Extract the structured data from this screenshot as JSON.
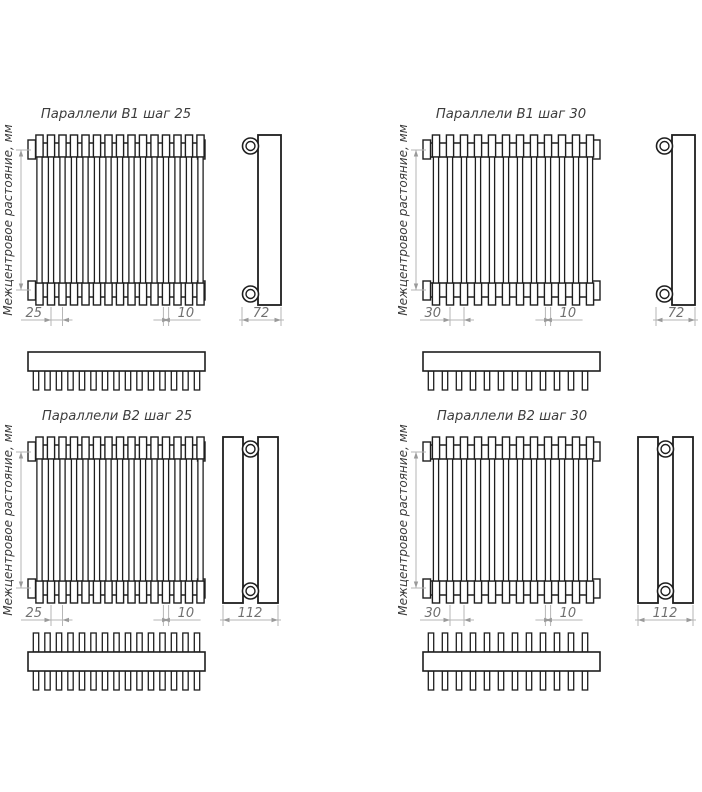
{
  "colors": {
    "background": "#ffffff",
    "line": "#1e1e1e",
    "dim_line": "#b6b6b6",
    "dim_arrow": "#9a9a9a",
    "dim_text": "#707070",
    "label_text": "#3c3c3c"
  },
  "axis_label": "Межцентровое растояние, мм",
  "quadrants": [
    {
      "id": "b1-step-25",
      "title": "Параллели В1 шаг 25",
      "variant": "B1",
      "tube_rows": 1,
      "tube_count": 15,
      "dim_pitch": "25",
      "dim_tube_width": "10",
      "dim_depth": "72"
    },
    {
      "id": "b1-step-30",
      "title": "Параллели В1 шаг 30",
      "variant": "B1",
      "tube_rows": 1,
      "tube_count": 12,
      "dim_pitch": "30",
      "dim_tube_width": "10",
      "dim_depth": "72"
    },
    {
      "id": "b2-step-25",
      "title": "Параллели В2 шаг 25",
      "variant": "B2",
      "tube_rows": 2,
      "tube_count": 15,
      "dim_pitch": "25",
      "dim_tube_width": "10",
      "dim_depth": "112"
    },
    {
      "id": "b2-step-30",
      "title": "Параллели В2 шаг 30",
      "variant": "B2",
      "tube_rows": 2,
      "tube_count": 12,
      "dim_pitch": "30",
      "dim_tube_width": "10",
      "dim_depth": "112"
    }
  ]
}
